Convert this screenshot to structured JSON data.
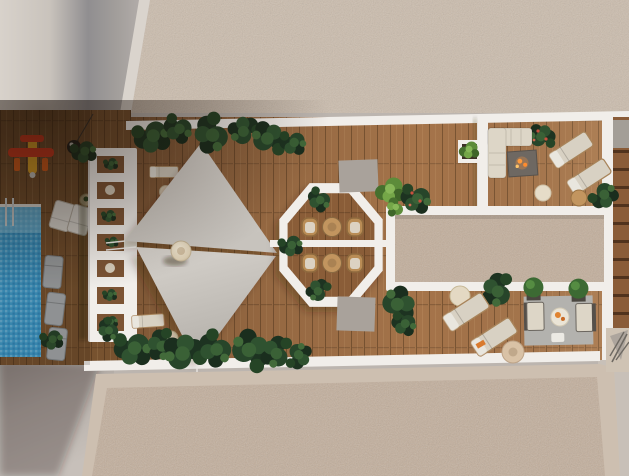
{
  "scene": {
    "type": "architectural-render",
    "view": "top-down-aerial",
    "subject": "rooftop terrace with pool, shade sails and lounge areas",
    "features": [
      "swimming pool with mosaic tiles and ladder",
      "sun loungers beside pool",
      "toy seaplane on deck",
      "black pendant lamp",
      "white pergola planter wall",
      "two triangular shade sails",
      "round daybed",
      "octagonal dining nook with two round tables and four wicker chairs",
      "concrete roof blocks",
      "gravel skylight strip with white frame",
      "L-shaped outdoor sofa",
      "fire pit table",
      "double sun loungers with side tables",
      "lounge set on grey rug with ball trees",
      "wooden stair strip",
      "speckled gravel roof fields",
      "tropical bushes along deck edges"
    ],
    "colors": {
      "plaster": "#bcb5af",
      "plasterLight": "#d7d1ca",
      "plasterShadow": "#8f8d8f",
      "gravel": "#cbbcac",
      "gravelInner": "#c2ae9b",
      "gravelFrame": "#cdbfb0",
      "deck": "#a5744a",
      "deckShadow": "#77522f",
      "white": "#f1eeea",
      "pool": "#3e9ecf",
      "poolLight": "#8ecde9",
      "sail": "#d9d5cf",
      "sailShade": "#bdb9b3",
      "foliageDark": "#24402a",
      "foliageBright": "#6f9a43",
      "wicker": "#b98c55",
      "woodFurniture": "#c2955f",
      "cushion": "#ddd6c7",
      "concrete": "#a9a29b",
      "rug": "#b3b2ae",
      "fire": "#ff9a3c",
      "toyRed": "#e03d20",
      "toyYellow": "#f0b02a",
      "daybed": "#e7dcc6",
      "steps": "#8a5c38"
    }
  }
}
